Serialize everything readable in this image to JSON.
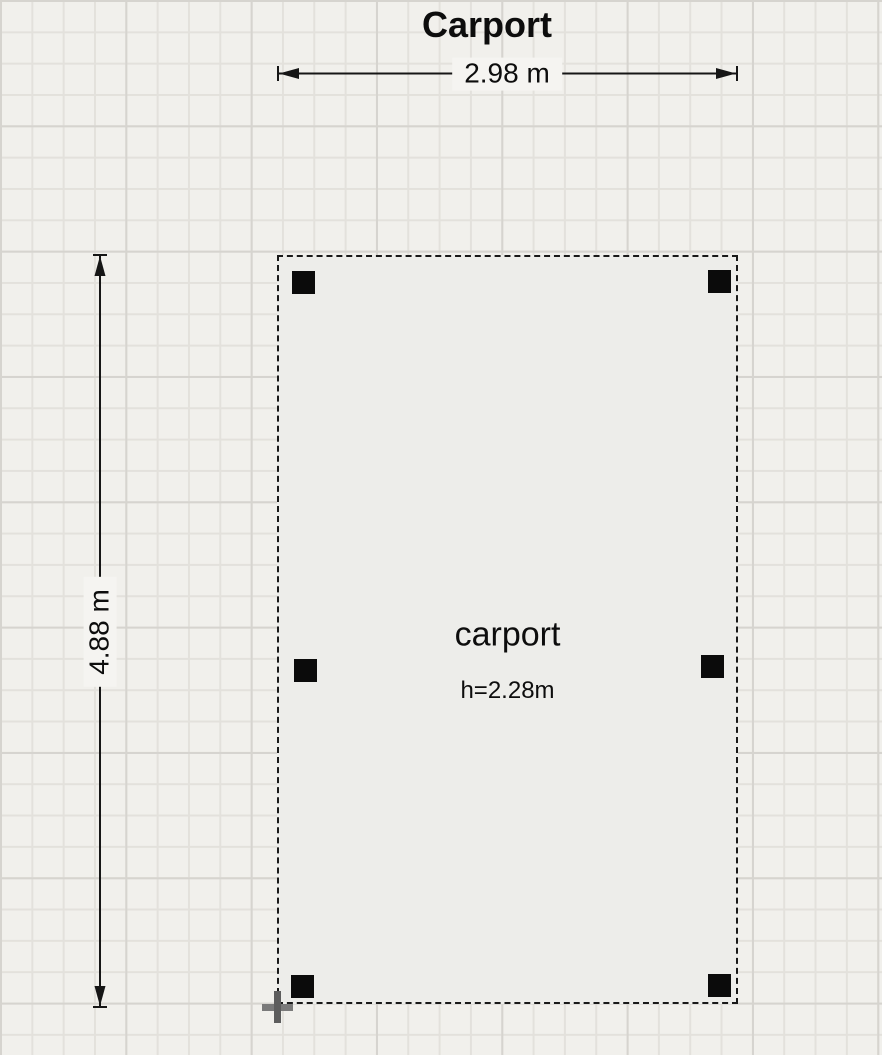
{
  "title": "Carport",
  "dimensions": {
    "width_label": "2.98 m",
    "height_label": "4.88 m"
  },
  "room": {
    "name": "carport",
    "height_label": "h=2.28m",
    "posts": [
      {
        "x": 13,
        "y": 14
      },
      {
        "x": 429,
        "y": 13
      },
      {
        "x": 15,
        "y": 402
      },
      {
        "x": 422,
        "y": 398
      },
      {
        "x": 12,
        "y": 718
      },
      {
        "x": 429,
        "y": 717
      }
    ]
  },
  "colors": {
    "canvas_background": "#f1f0ec",
    "grid_line_minor": "#e3e1dc",
    "grid_line_major": "#d6d4cf",
    "room_fill": "#ededea",
    "outline_ink": "#161616",
    "post_fill": "#0b0b0b",
    "cursor_gray": "#5d5d5d",
    "dim_label_background": "#f5f4f1"
  }
}
